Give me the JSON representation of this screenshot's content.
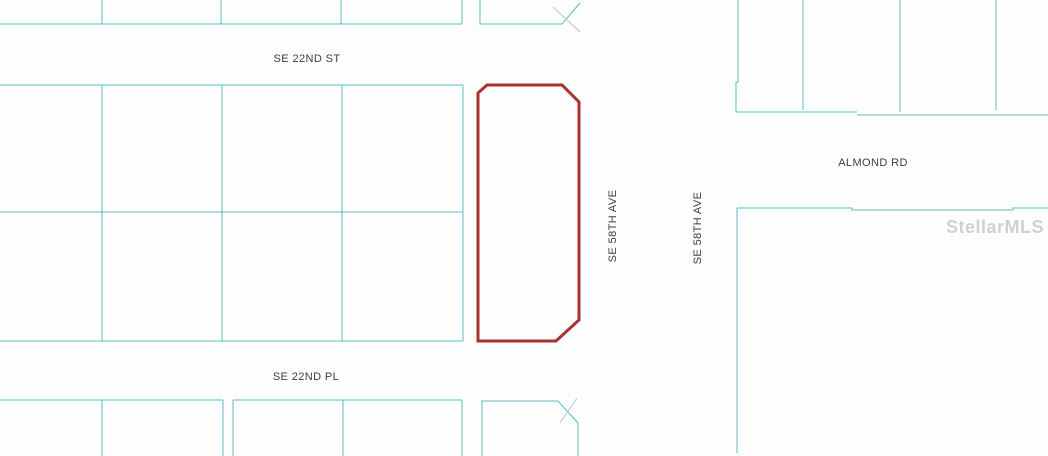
{
  "map": {
    "background": "#fdfdfd",
    "line_color": "#59bfbf",
    "faint_line_color": "#b7c6c6",
    "highlight_color": "#a83232",
    "label_color": "#3d3d3d",
    "watermark": {
      "text": "StellarMLS",
      "color": "#c9c9c9"
    },
    "labels": [
      {
        "id": "se-22nd-st",
        "text": "SE 22ND ST",
        "x": 307,
        "y": 59,
        "rotate": 0
      },
      {
        "id": "se-58th-ave-west",
        "text": "SE 58TH AVE",
        "x": 613,
        "y": 226,
        "rotate": -90
      },
      {
        "id": "se-58th-ave-east",
        "text": "SE 58TH AVE",
        "x": 698,
        "y": 228,
        "rotate": -90
      },
      {
        "id": "almond-rd",
        "text": "ALMOND RD",
        "x": 873,
        "y": 163,
        "rotate": 0
      },
      {
        "id": "se-22nd-pl",
        "text": "SE 22ND PL",
        "x": 306,
        "y": 377,
        "rotate": 0
      }
    ],
    "highlight_parcel": {
      "name": "highlighted-subject-parcel",
      "stroke_width": 3,
      "closed": true,
      "points": [
        [
          478,
          93
        ],
        [
          487,
          85
        ],
        [
          562,
          85
        ],
        [
          579,
          102
        ],
        [
          579,
          320
        ],
        [
          556,
          341
        ],
        [
          478,
          341
        ]
      ]
    },
    "lines": [
      {
        "name": "north-block-bottom-edge",
        "points": [
          [
            0,
            24
          ],
          [
            462,
            24
          ]
        ]
      },
      {
        "name": "north-block-divider-1",
        "points": [
          [
            102,
            0
          ],
          [
            102,
            24
          ]
        ]
      },
      {
        "name": "north-block-divider-2",
        "points": [
          [
            221,
            0
          ],
          [
            221,
            24
          ]
        ]
      },
      {
        "name": "north-block-divider-3",
        "points": [
          [
            341,
            0
          ],
          [
            341,
            24
          ]
        ]
      },
      {
        "name": "north-block-right-edge",
        "points": [
          [
            462,
            0
          ],
          [
            462,
            24
          ]
        ]
      },
      {
        "name": "north-corner-parcel-outline",
        "points": [
          [
            480,
            0
          ],
          [
            480,
            24
          ],
          [
            562,
            24
          ],
          [
            580,
            3
          ]
        ]
      },
      {
        "name": "north-corner-artifact-line",
        "points": [
          [
            553,
            7
          ],
          [
            580,
            32
          ]
        ],
        "faint": true
      },
      {
        "name": "west-grid-top-edge",
        "points": [
          [
            0,
            85
          ],
          [
            463,
            85
          ]
        ]
      },
      {
        "name": "west-grid-middle-edge",
        "points": [
          [
            0,
            212
          ],
          [
            463,
            212
          ]
        ]
      },
      {
        "name": "west-grid-bottom-edge",
        "points": [
          [
            0,
            341
          ],
          [
            463,
            341
          ]
        ]
      },
      {
        "name": "west-grid-divider-1",
        "points": [
          [
            102,
            85
          ],
          [
            102,
            341
          ]
        ]
      },
      {
        "name": "west-grid-divider-2",
        "points": [
          [
            222,
            85
          ],
          [
            222,
            341
          ]
        ]
      },
      {
        "name": "west-grid-divider-3",
        "points": [
          [
            342,
            85
          ],
          [
            342,
            341
          ]
        ]
      },
      {
        "name": "west-grid-right-edge",
        "points": [
          [
            463,
            85
          ],
          [
            463,
            341
          ]
        ]
      },
      {
        "name": "south-block-a-top-edge",
        "points": [
          [
            0,
            400
          ],
          [
            223,
            400
          ]
        ]
      },
      {
        "name": "south-block-a-divider",
        "points": [
          [
            102,
            400
          ],
          [
            102,
            456
          ]
        ]
      },
      {
        "name": "south-block-a-right-edge",
        "points": [
          [
            223,
            400
          ],
          [
            223,
            456
          ]
        ]
      },
      {
        "name": "south-block-b-top-edge",
        "points": [
          [
            233,
            400
          ],
          [
            462,
            400
          ]
        ]
      },
      {
        "name": "south-block-b-left-edge",
        "points": [
          [
            233,
            400
          ],
          [
            233,
            456
          ]
        ]
      },
      {
        "name": "south-block-b-divider",
        "points": [
          [
            343,
            400
          ],
          [
            343,
            456
          ]
        ]
      },
      {
        "name": "south-block-b-right-edge",
        "points": [
          [
            462,
            400
          ],
          [
            462,
            456
          ]
        ]
      },
      {
        "name": "south-corner-parcel-outline",
        "points": [
          [
            482,
            456
          ],
          [
            482,
            401
          ],
          [
            558,
            401
          ],
          [
            578,
            423
          ],
          [
            578,
            456
          ]
        ]
      },
      {
        "name": "south-corner-artifact-line",
        "points": [
          [
            577,
            398
          ],
          [
            560,
            423
          ]
        ],
        "faint": true
      },
      {
        "name": "northeast-block-left-edge",
        "points": [
          [
            738,
            0
          ],
          [
            738,
            82
          ],
          [
            736,
            82
          ],
          [
            736,
            112
          ]
        ]
      },
      {
        "name": "northeast-block-divider-1",
        "points": [
          [
            803,
            0
          ],
          [
            803,
            110
          ]
        ]
      },
      {
        "name": "northeast-block-divider-2",
        "points": [
          [
            900,
            0
          ],
          [
            900,
            112
          ]
        ]
      },
      {
        "name": "northeast-block-divider-3",
        "points": [
          [
            996,
            0
          ],
          [
            996,
            110
          ]
        ]
      },
      {
        "name": "northeast-block-bottom-edge-west",
        "points": [
          [
            736,
            112
          ],
          [
            857,
            112
          ]
        ]
      },
      {
        "name": "northeast-block-bottom-edge-east",
        "points": [
          [
            857,
            115
          ],
          [
            1048,
            115
          ]
        ]
      },
      {
        "name": "east-parcel-top-edge",
        "points": [
          [
            737,
            208
          ],
          [
            852,
            208
          ],
          [
            852,
            210
          ],
          [
            1013,
            210
          ],
          [
            1013,
            208
          ],
          [
            1048,
            208
          ]
        ]
      },
      {
        "name": "east-parcel-left-edge",
        "points": [
          [
            737,
            208
          ],
          [
            737,
            453
          ]
        ]
      }
    ]
  }
}
